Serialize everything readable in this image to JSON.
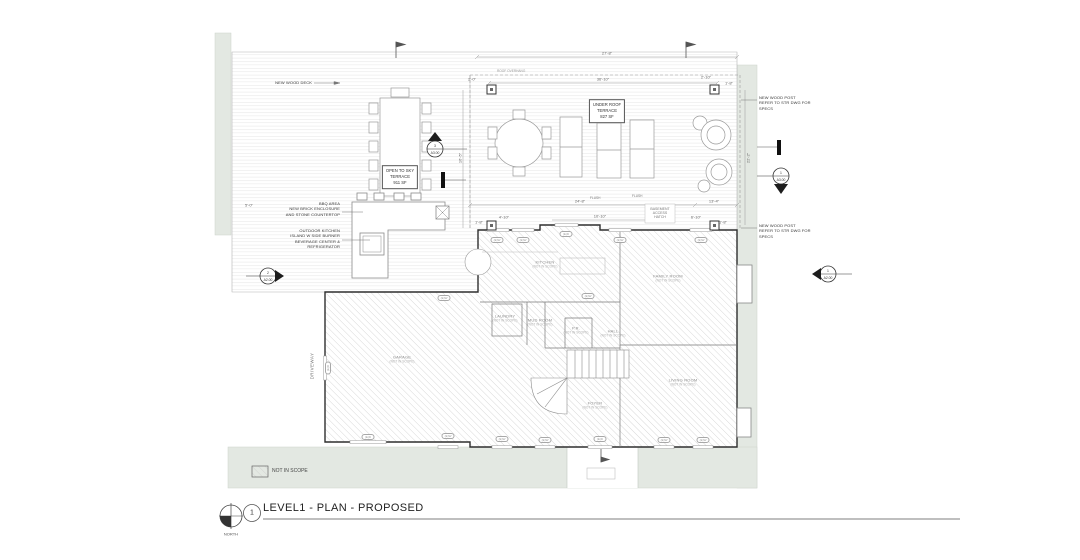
{
  "title_block": {
    "sheet_callout": "1",
    "title": "LEVEL1 - PLAN - PROPOSED",
    "north_label": "NORTH"
  },
  "legend": {
    "not_in_scope": "NOT IN SCOPE"
  },
  "annotations": {
    "wood_deck": "NEW WOOD DECK",
    "bbq": "BBQ AREA\nNEW BRICK ENCLOSURE\nAND STONE COUNTERTOP",
    "outdoor_kitchen": "OUTDOOR KITCHEN\nISLAND W SIDE BURNER\nBEVERAGE CENTER &\nREFRIGERATOR",
    "wood_post": "NEW WOOD POST\nREFER TO STR DWG FOR\nSPECS",
    "basement_hatch": "BASEMENT\nACCESS\nHATCH",
    "roof_overhang": "ROOF OVERHANG",
    "flush": "FLUSH",
    "driveway": "DRIVEWAY"
  },
  "areas": {
    "open_terrace": {
      "line1": "OPEN TO SKY",
      "line2": "TERRACE",
      "line3": "911 SF"
    },
    "roof_terrace": {
      "line1": "UNDER ROOF",
      "line2": "TERRACE",
      "line3": "827 SF"
    }
  },
  "rooms": {
    "kitchen": {
      "name": "KITCHEN",
      "sub": "(NOT IN SCOPE)"
    },
    "family": {
      "name": "FAMILY ROOM",
      "sub": "(NOT IN SCOPE)"
    },
    "laundry": {
      "name": "LAUNDRY",
      "sub": "(NOT IN SCOPE)"
    },
    "mud": {
      "name": "MUD ROOM",
      "sub": "(NOT IN SCOPE)"
    },
    "pr": {
      "name": "P.R.",
      "sub": "(NOT IN SCOPE)"
    },
    "hall": {
      "name": "HALL",
      "sub": "(NOT IN SCOPE)"
    },
    "foyer": {
      "name": "FOYER",
      "sub": "(NOT IN SCOPE)"
    },
    "living": {
      "name": "LIVING ROOM",
      "sub": "(NOT IN SCOPE)"
    },
    "garage": {
      "name": "GARAGE",
      "sub": "(NOT IN SCOPE)"
    }
  },
  "markers": {
    "section_deck": {
      "num": "3",
      "sheet": "A3.00"
    },
    "section_right": {
      "num": "1",
      "sheet": "A3.00"
    },
    "elev_left": {
      "num": "2",
      "sheet": "A2.00"
    },
    "elev_right": {
      "num": "1",
      "sheet": "A2.00"
    }
  },
  "dimensions": {
    "top_outer": "27'-8\"",
    "top_inner": "36'-10\"",
    "mid_left": "24'-8\"",
    "mid_right": "13'-4\"",
    "mid_inner": "10'-10\"",
    "left_vert": "16'-5\"",
    "right_vert": "22'-2\"",
    "s1": "2'-0\"",
    "s2": "2'-10\"",
    "s3": "1'-8\"",
    "s4": "1'-8\"",
    "s5": "4'-10\"",
    "s6": "6'-10\"",
    "s7": "1'-8\"",
    "s8": "5'-0\""
  },
  "tags": {
    "top": [
      "(E)W",
      "(E)W",
      "(E)D",
      "(E)W",
      "(E)W"
    ],
    "bottom": [
      "(E)D",
      "(E)W",
      "(E)W",
      "(E)W",
      "(E)D",
      "(E)W",
      "(E)W"
    ],
    "side": "(E)D",
    "garage": "(E)W",
    "kitchen": "(E)W"
  },
  "colors": {
    "site_green": "#e3e8e2",
    "wall": "#2f2f2f",
    "hatch": "#c9c9c9"
  }
}
